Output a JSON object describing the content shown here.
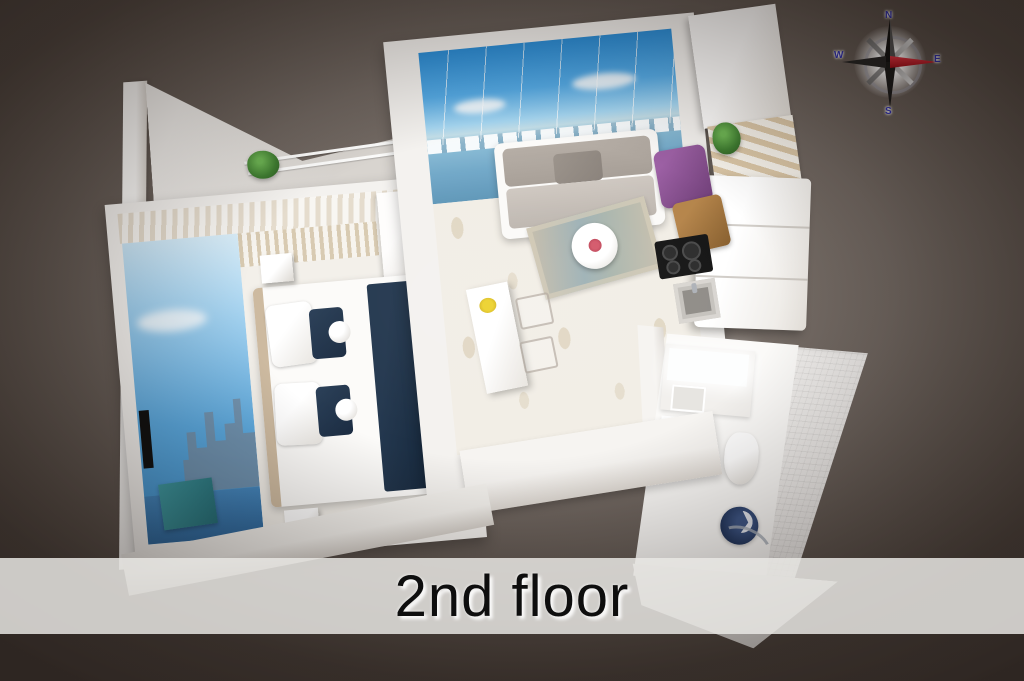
{
  "scene": {
    "banner": {
      "title": "2nd floor"
    },
    "compass": {
      "north": "N",
      "east": "E",
      "south": "S",
      "west": "W",
      "needle_east_color": "#b90f1b"
    },
    "palette": {
      "background_center": "#7d746d",
      "background_edge": "#423a36",
      "banner_background": "rgba(233,232,229,0.84)",
      "banner_text": "#0e0e0e",
      "wall_white": "#f4f2ef",
      "mural_sky_blue": "#3b8cc8",
      "marina_water_blue": "#6fa9c9",
      "sofa_gray": "#b6aea6",
      "bed_navy": "#1f3148",
      "accent_purple": "#7f4a85",
      "accent_brown": "#a5793f",
      "teal_bench": "#2f8b94",
      "plant_green": "#3f7d31",
      "shower_navy": "#22365c",
      "flower_yellow": "#ecd22e",
      "flower_red": "#c44f5e"
    }
  }
}
